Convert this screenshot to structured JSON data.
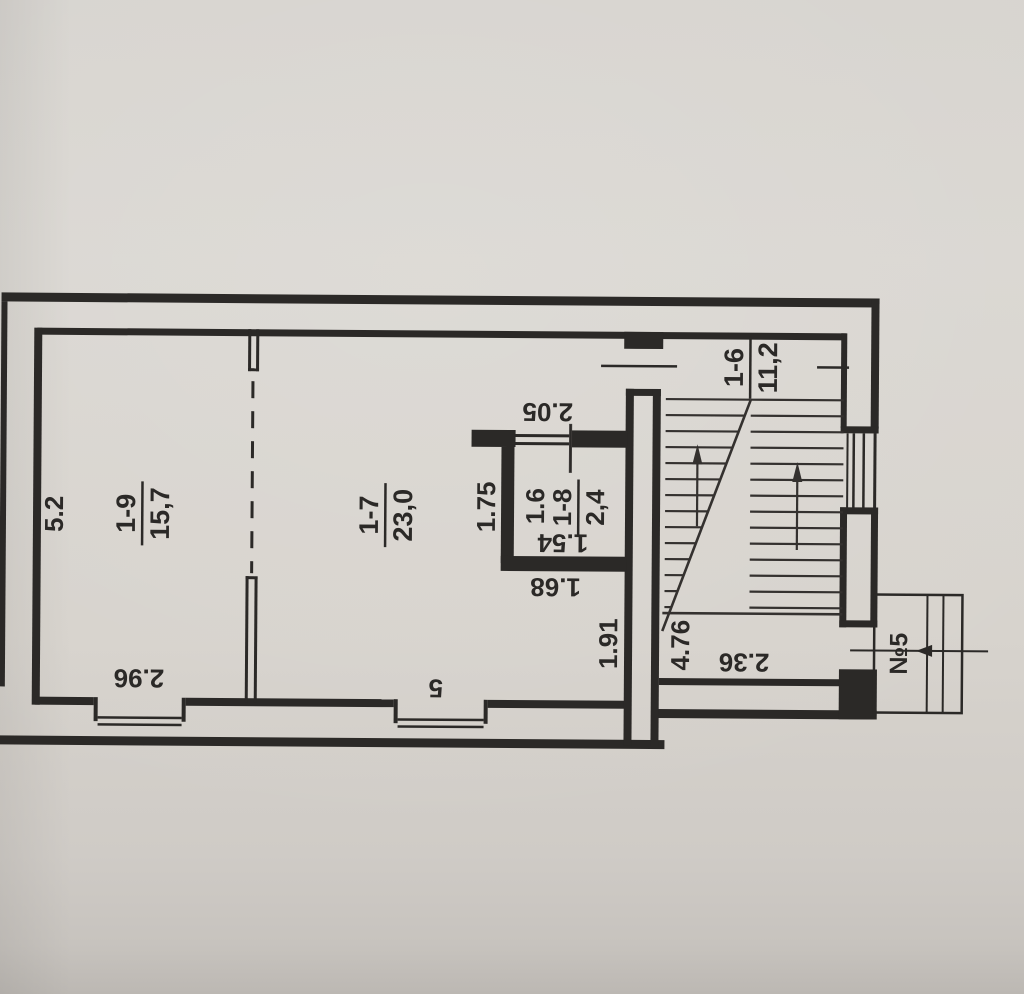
{
  "plan": {
    "rooms": [
      {
        "number": "1-9",
        "area": "15,7"
      },
      {
        "number": "1-7",
        "area": "23,0"
      },
      {
        "number": "1-8",
        "area": "2,4"
      },
      {
        "number": "1-6",
        "area": "11,2"
      }
    ],
    "dimensions": {
      "left_height": "5.2",
      "room19_width": "2.96",
      "room17_width": "5",
      "room17_lower_height": "1.91",
      "closet_outer_height": "1.75",
      "closet_inner_height": "1.6",
      "closet_top_width": "2.05",
      "closet_inner_width": "1.54",
      "closet_bottom_width": "1.68",
      "stair_hall_height": "4.76",
      "stair_hall_width": "2.36"
    },
    "entrance_label": "№5",
    "ink_color": "#2b2927",
    "paper_color": "#d7d4cf"
  }
}
